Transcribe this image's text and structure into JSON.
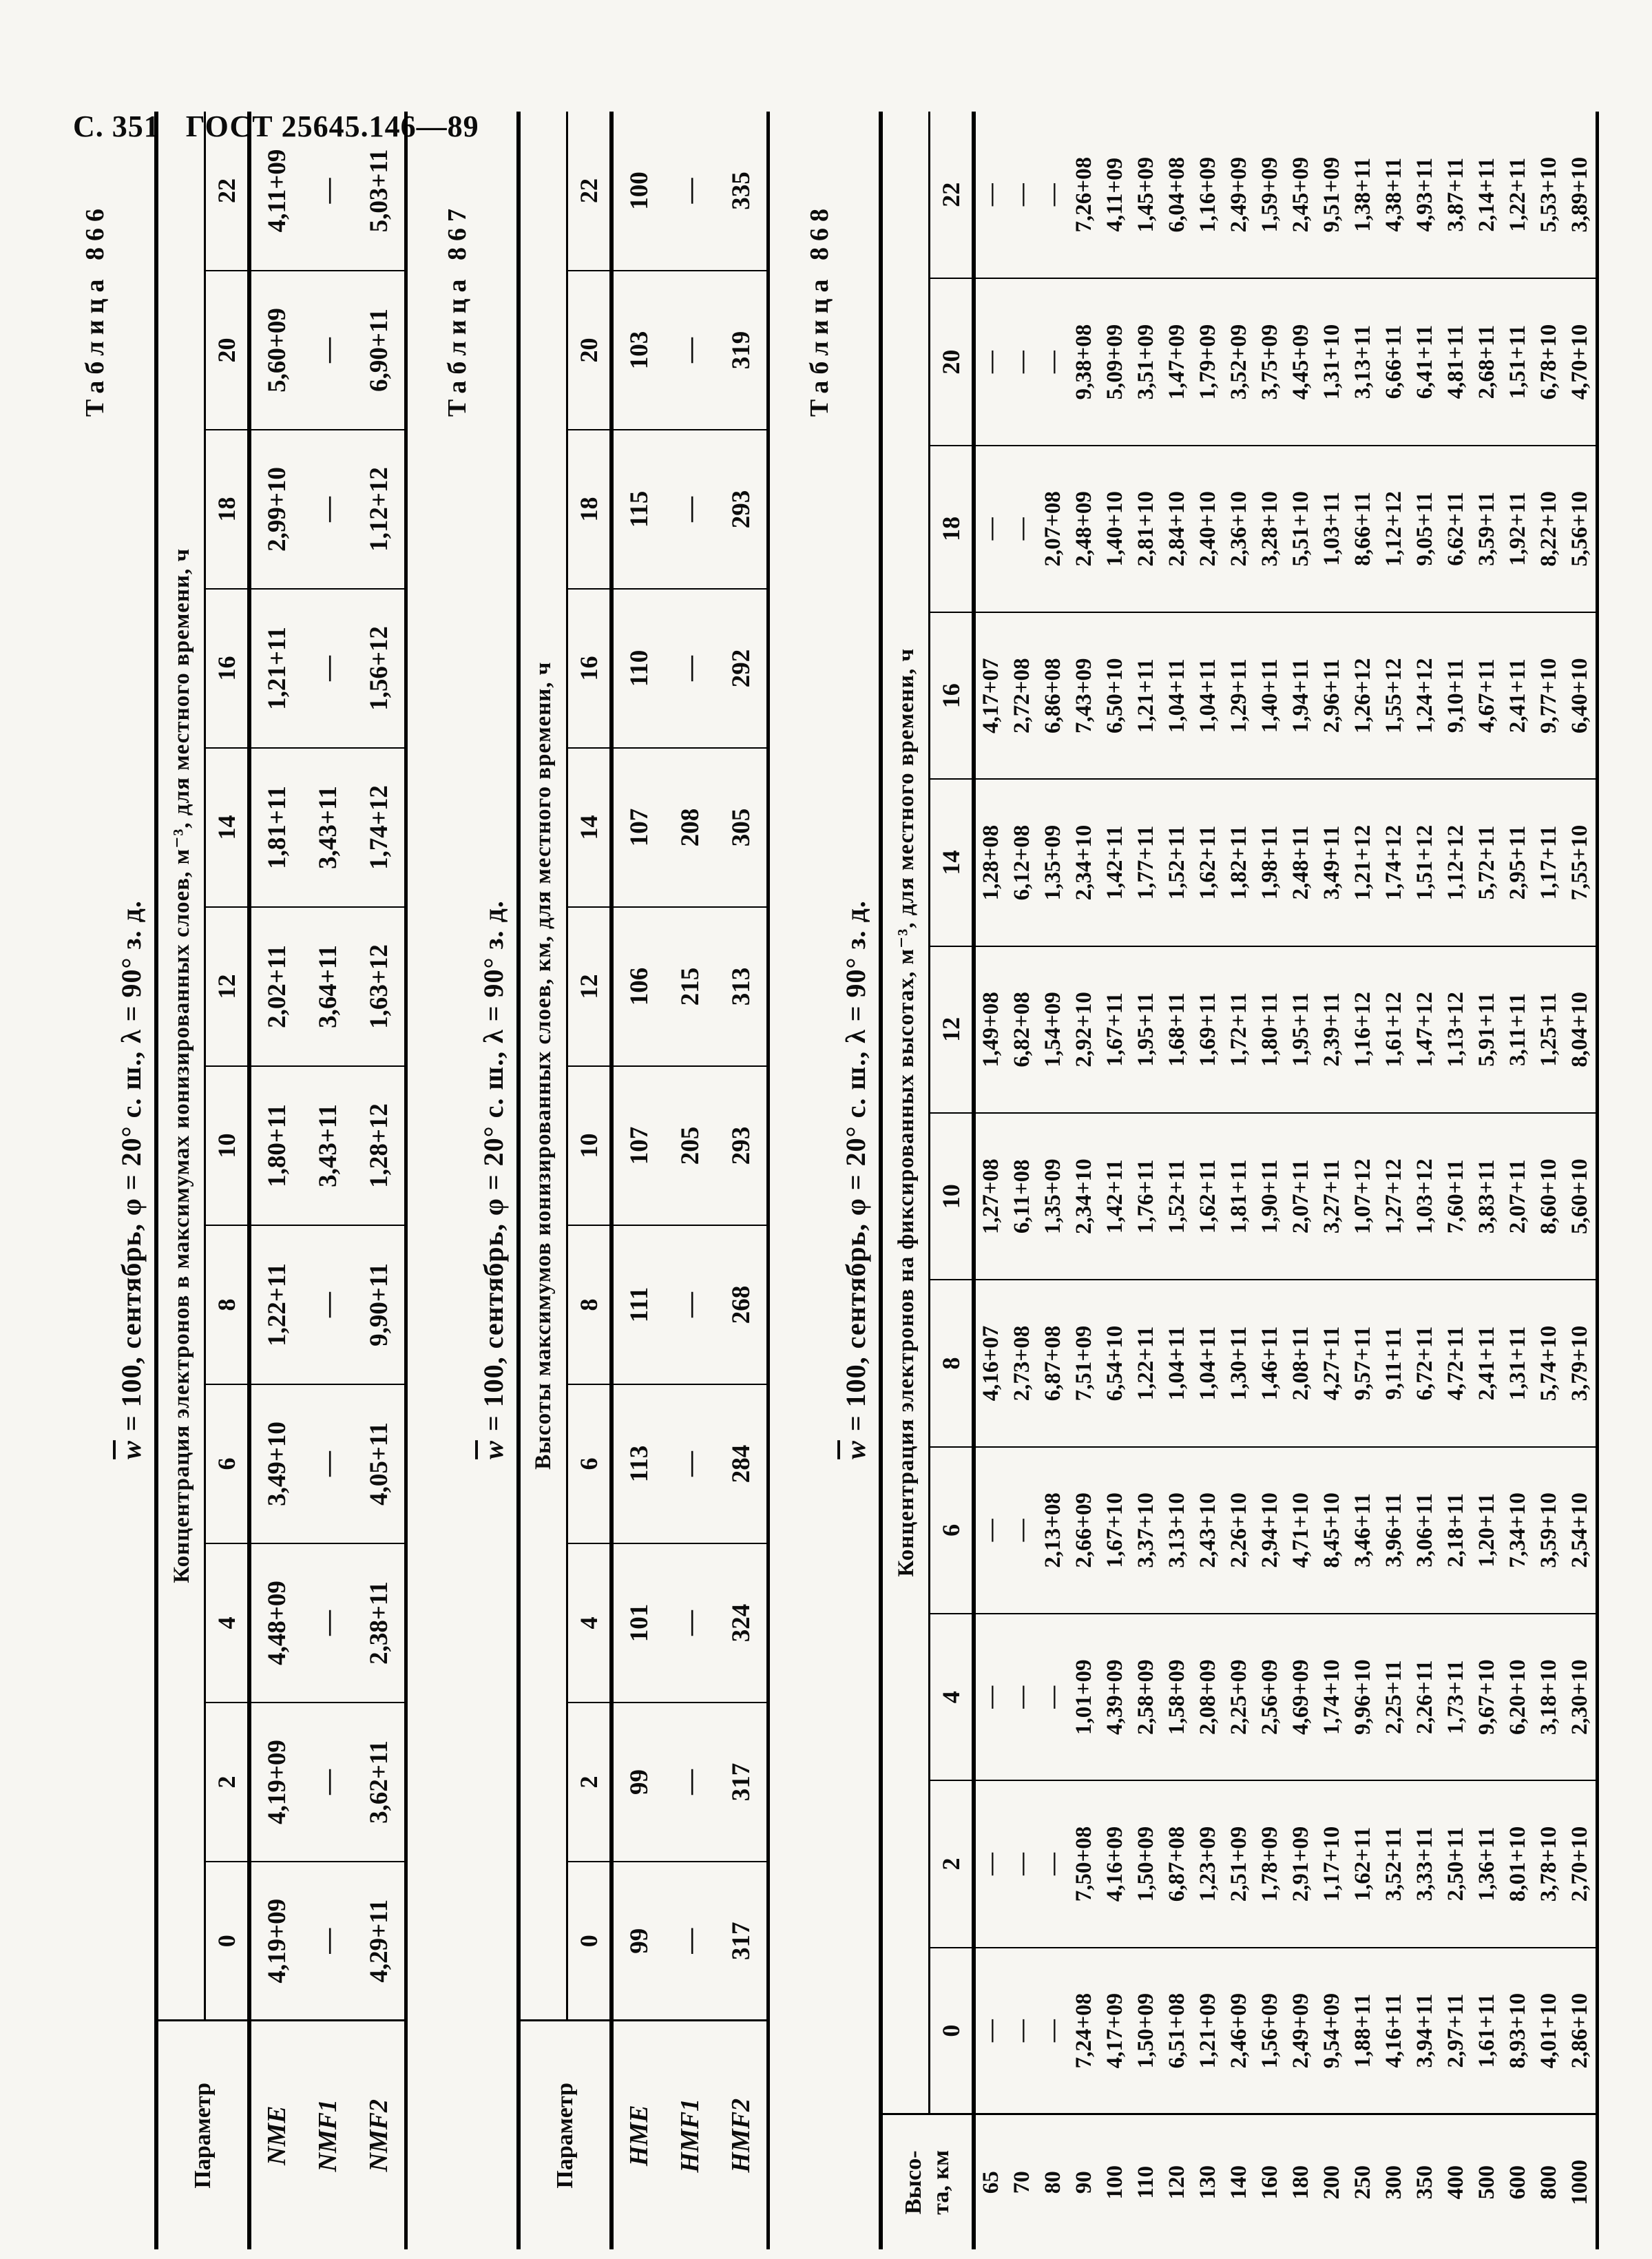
{
  "page": {
    "header_page": "С. 351",
    "header_doc": "ГОСТ 25645.146—89"
  },
  "tables": [
    {
      "label": "Таблица 866",
      "title_w": "w",
      "title_rest": " = 100,  сентябрь,  φ = 20°  с. ш.,  λ = 90°  з. д.",
      "param_header_lines": [
        "Параметр"
      ],
      "span_header": "Концентрация электронов в максимумах ионизированных слоев, м⁻³, для местного времени, ч",
      "hours": [
        "0",
        "2",
        "4",
        "6",
        "8",
        "10",
        "12",
        "14",
        "16",
        "18",
        "20",
        "22"
      ],
      "rows": [
        {
          "param": "NME",
          "values": [
            "4,19+09",
            "4,19+09",
            "4,48+09",
            "3,49+10",
            "1,22+11",
            "1,80+11",
            "2,02+11",
            "1,81+11",
            "1,21+11",
            "2,99+10",
            "5,60+09",
            "4,11+09"
          ]
        },
        {
          "param": "NMF1",
          "values": [
            "—",
            "—",
            "—",
            "—",
            "—",
            "3,43+11",
            "3,64+11",
            "3,43+11",
            "—",
            "—",
            "—",
            "—"
          ]
        },
        {
          "param": "NMF2",
          "values": [
            "4,29+11",
            "3,62+11",
            "2,38+11",
            "4,05+11",
            "9,90+11",
            "1,28+12",
            "1,63+12",
            "1,74+12",
            "1,56+12",
            "1,12+12",
            "6,90+11",
            "5,03+11"
          ]
        }
      ]
    },
    {
      "label": "Таблица 867",
      "title_w": "w",
      "title_rest": " = 100,  сентябрь,  φ = 20°  с. ш.,  λ = 90°  з. д.",
      "param_header_lines": [
        "Параметр"
      ],
      "span_header": "Высоты максимумов ионизированных слоев, км, для местного времени, ч",
      "hours": [
        "0",
        "2",
        "4",
        "6",
        "8",
        "10",
        "12",
        "14",
        "16",
        "18",
        "20",
        "22"
      ],
      "rows": [
        {
          "param": "HME",
          "values": [
            "99",
            "99",
            "101",
            "113",
            "111",
            "107",
            "106",
            "107",
            "110",
            "115",
            "103",
            "100"
          ]
        },
        {
          "param": "HMF1",
          "values": [
            "—",
            "—",
            "—",
            "—",
            "—",
            "205",
            "215",
            "208",
            "—",
            "—",
            "—",
            "—"
          ]
        },
        {
          "param": "HMF2",
          "values": [
            "317",
            "317",
            "324",
            "284",
            "268",
            "293",
            "313",
            "305",
            "292",
            "293",
            "319",
            "335"
          ]
        }
      ]
    },
    {
      "label": "Таблица 868",
      "title_w": "w",
      "title_rest": " = 100,  сентябрь,  φ = 20°  с. ш.,  λ = 90°  з. д.",
      "param_header_lines": [
        "Высо-",
        "та, км"
      ],
      "span_header": "Концентрация электронов на фиксированных высотах, м⁻³, для местного времени, ч",
      "hours": [
        "0",
        "2",
        "4",
        "6",
        "8",
        "10",
        "12",
        "14",
        "16",
        "18",
        "20",
        "22"
      ],
      "rows": [
        {
          "param": "65",
          "values": [
            "—",
            "—",
            "—",
            "—",
            "4,16+07",
            "1,27+08",
            "1,49+08",
            "1,28+08",
            "4,17+07",
            "—",
            "—",
            "—"
          ]
        },
        {
          "param": "70",
          "values": [
            "—",
            "—",
            "—",
            "—",
            "2,73+08",
            "6,11+08",
            "6,82+08",
            "6,12+08",
            "2,72+08",
            "—",
            "—",
            "—"
          ]
        },
        {
          "param": "80",
          "values": [
            "—",
            "—",
            "—",
            "2,13+08",
            "6,87+08",
            "1,35+09",
            "1,54+09",
            "1,35+09",
            "6,86+08",
            "2,07+08",
            "—",
            "—"
          ]
        },
        {
          "param": "90",
          "values": [
            "7,24+08",
            "7,50+08",
            "1,01+09",
            "2,66+09",
            "7,51+09",
            "2,34+10",
            "2,92+10",
            "2,34+10",
            "7,43+09",
            "2,48+09",
            "9,38+08",
            "7,26+08"
          ]
        },
        {
          "param": "100",
          "values": [
            "4,17+09",
            "4,16+09",
            "4,39+09",
            "1,67+10",
            "6,54+10",
            "1,42+11",
            "1,67+11",
            "1,42+11",
            "6,50+10",
            "1,40+10",
            "5,09+09",
            "4,11+09"
          ]
        },
        {
          "param": "110",
          "values": [
            "1,50+09",
            "1,50+09",
            "2,58+09",
            "3,37+10",
            "1,22+11",
            "1,76+11",
            "1,95+11",
            "1,77+11",
            "1,21+11",
            "2,81+10",
            "3,51+09",
            "1,45+09"
          ]
        },
        {
          "param": "120",
          "values": [
            "6,51+08",
            "6,87+08",
            "1,58+09",
            "3,13+10",
            "1,04+11",
            "1,52+11",
            "1,68+11",
            "1,52+11",
            "1,04+11",
            "2,84+10",
            "1,47+09",
            "6,04+08"
          ]
        },
        {
          "param": "130",
          "values": [
            "1,21+09",
            "1,23+09",
            "2,08+09",
            "2,43+10",
            "1,04+11",
            "1,62+11",
            "1,69+11",
            "1,62+11",
            "1,04+11",
            "2,40+10",
            "1,79+09",
            "1,16+09"
          ]
        },
        {
          "param": "140",
          "values": [
            "2,46+09",
            "2,51+09",
            "2,25+09",
            "2,26+10",
            "1,30+11",
            "1,81+11",
            "1,72+11",
            "1,82+11",
            "1,29+11",
            "2,36+10",
            "3,52+09",
            "2,49+09"
          ]
        },
        {
          "param": "160",
          "values": [
            "1,56+09",
            "1,78+09",
            "2,56+09",
            "2,94+10",
            "1,46+11",
            "1,90+11",
            "1,80+11",
            "1,98+11",
            "1,40+11",
            "3,28+10",
            "3,75+09",
            "1,59+09"
          ]
        },
        {
          "param": "180",
          "values": [
            "2,49+09",
            "2,91+09",
            "4,69+09",
            "4,71+10",
            "2,08+11",
            "2,07+11",
            "1,95+11",
            "2,48+11",
            "1,94+11",
            "5,51+10",
            "4,45+09",
            "2,45+09"
          ]
        },
        {
          "param": "200",
          "values": [
            "9,54+09",
            "1,17+10",
            "1,74+10",
            "8,45+10",
            "4,27+11",
            "3,27+11",
            "2,39+11",
            "3,49+11",
            "2,96+11",
            "1,03+11",
            "1,31+10",
            "9,51+09"
          ]
        },
        {
          "param": "250",
          "values": [
            "1,88+11",
            "1,62+11",
            "9,96+10",
            "3,46+11",
            "9,57+11",
            "1,07+12",
            "1,16+12",
            "1,21+12",
            "1,26+12",
            "8,66+11",
            "3,13+11",
            "1,38+11"
          ]
        },
        {
          "param": "300",
          "values": [
            "4,16+11",
            "3,52+11",
            "2,25+11",
            "3,96+11",
            "9,11+11",
            "1,27+12",
            "1,61+12",
            "1,74+12",
            "1,55+12",
            "1,12+12",
            "6,66+11",
            "4,38+11"
          ]
        },
        {
          "param": "350",
          "values": [
            "3,94+11",
            "3,33+11",
            "2,26+11",
            "3,06+11",
            "6,72+11",
            "1,03+12",
            "1,47+12",
            "1,51+12",
            "1,24+12",
            "9,05+11",
            "6,41+11",
            "4,93+11"
          ]
        },
        {
          "param": "400",
          "values": [
            "2,97+11",
            "2,50+11",
            "1,73+11",
            "2,18+11",
            "4,72+11",
            "7,60+11",
            "1,13+12",
            "1,12+12",
            "9,10+11",
            "6,62+11",
            "4,81+11",
            "3,87+11"
          ]
        },
        {
          "param": "500",
          "values": [
            "1,61+11",
            "1,36+11",
            "9,67+10",
            "1,20+11",
            "2,41+11",
            "3,83+11",
            "5,91+11",
            "5,72+11",
            "4,67+11",
            "3,59+11",
            "2,68+11",
            "2,14+11"
          ]
        },
        {
          "param": "600",
          "values": [
            "8,93+10",
            "8,01+10",
            "6,20+10",
            "7,34+10",
            "1,31+11",
            "2,07+11",
            "3,11+11",
            "2,95+11",
            "2,41+11",
            "1,92+11",
            "1,51+11",
            "1,22+11"
          ]
        },
        {
          "param": "800",
          "values": [
            "4,01+10",
            "3,78+10",
            "3,18+10",
            "3,59+10",
            "5,74+10",
            "8,60+10",
            "1,25+11",
            "1,17+11",
            "9,77+10",
            "8,22+10",
            "6,78+10",
            "5,53+10"
          ]
        },
        {
          "param": "1000",
          "values": [
            "2,86+10",
            "2,70+10",
            "2,30+10",
            "2,54+10",
            "3,79+10",
            "5,60+10",
            "8,04+10",
            "7,55+10",
            "6,40+10",
            "5,56+10",
            "4,70+10",
            "3,89+10"
          ]
        }
      ]
    }
  ]
}
